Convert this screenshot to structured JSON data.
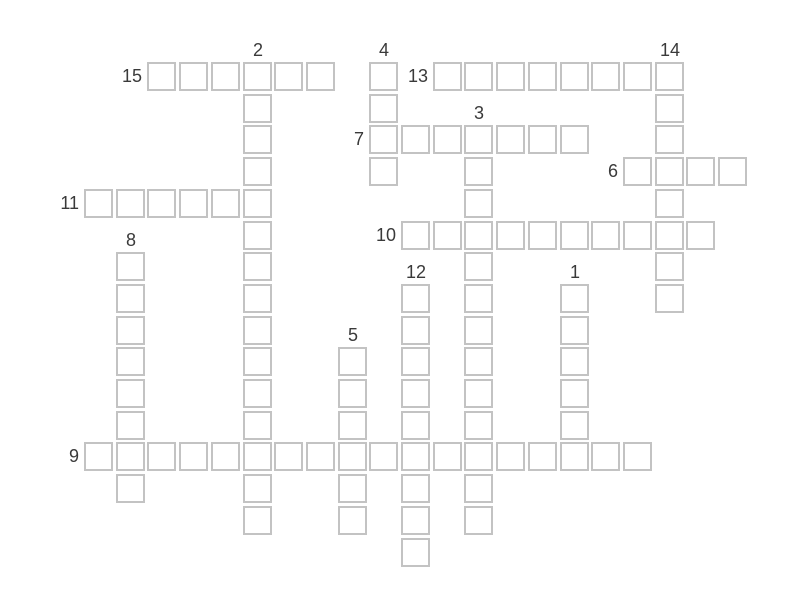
{
  "app": {
    "background_color": "#ffffff"
  },
  "crossword": {
    "cell_fill_color": "#ffffff",
    "cell_border_color": "#c3c3c3",
    "number_color": "#3a3a3a",
    "grid": {
      "origin_x": 84,
      "origin_y": 62,
      "pitch": 31.7,
      "cell_size": 29,
      "rows": 16,
      "cols": 21
    },
    "entries": [
      {
        "number": "1",
        "direction": "down",
        "row": 7,
        "col": 15,
        "length": 6
      },
      {
        "number": "2",
        "direction": "down",
        "row": 0,
        "col": 5,
        "length": 15
      },
      {
        "number": "3",
        "direction": "down",
        "row": 2,
        "col": 12,
        "length": 13
      },
      {
        "number": "4",
        "direction": "down",
        "row": 0,
        "col": 9,
        "length": 4
      },
      {
        "number": "5",
        "direction": "down",
        "row": 9,
        "col": 8,
        "length": 6
      },
      {
        "number": "6",
        "direction": "across",
        "row": 3,
        "col": 17,
        "length": 4
      },
      {
        "number": "7",
        "direction": "across",
        "row": 2,
        "col": 9,
        "length": 7
      },
      {
        "number": "8",
        "direction": "down",
        "row": 6,
        "col": 1,
        "length": 8
      },
      {
        "number": "9",
        "direction": "across",
        "row": 12,
        "col": 0,
        "length": 18
      },
      {
        "number": "10",
        "direction": "across",
        "row": 5,
        "col": 10,
        "length": 10
      },
      {
        "number": "11",
        "direction": "across",
        "row": 4,
        "col": 0,
        "length": 6
      },
      {
        "number": "12",
        "direction": "down",
        "row": 7,
        "col": 10,
        "length": 9
      },
      {
        "number": "13",
        "direction": "across",
        "row": 0,
        "col": 11,
        "length": 8
      },
      {
        "number": "14",
        "direction": "down",
        "row": 0,
        "col": 18,
        "length": 8
      },
      {
        "number": "15",
        "direction": "across",
        "row": 0,
        "col": 2,
        "length": 6
      }
    ]
  }
}
